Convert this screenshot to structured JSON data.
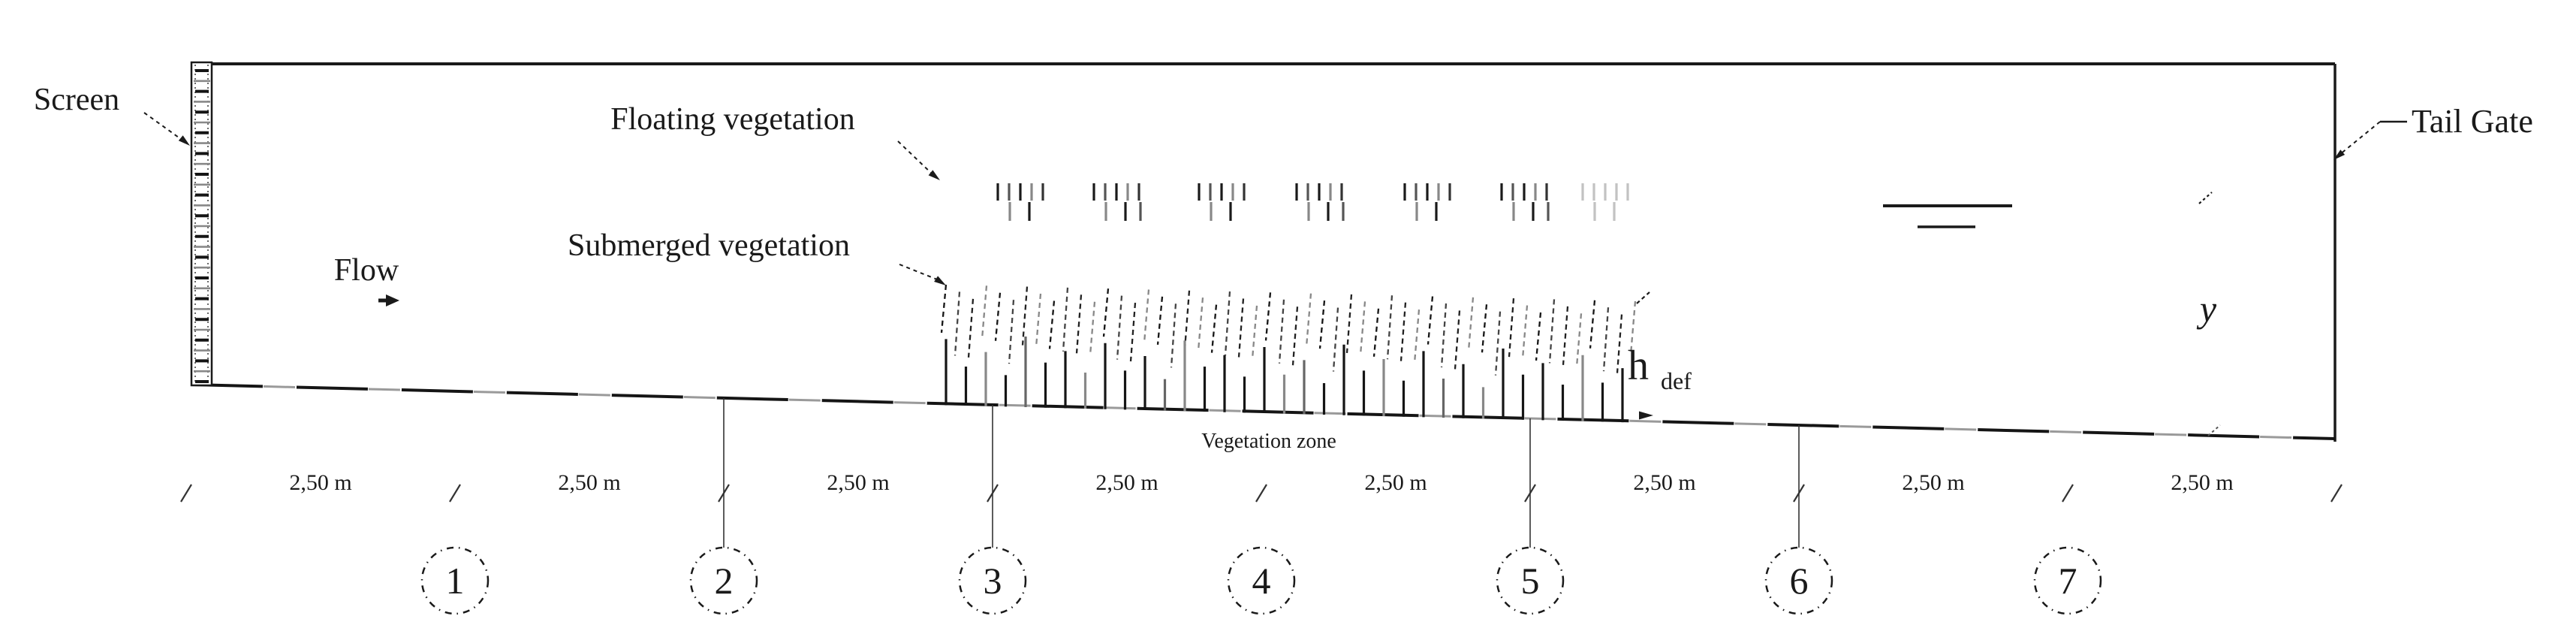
{
  "labels": {
    "screen": "Screen",
    "flow": "Flow",
    "floating_vegetation": "Floating vegetation",
    "submerged_vegetation": "Submerged vegetation",
    "vegetation_zone": "Vegetation zone",
    "h_def_base": "h",
    "h_def_sub": "def",
    "water_depth": "y",
    "tail_gate": "Tail Gate"
  },
  "dimensions": {
    "segment_labels": [
      "2,50 m",
      "2,50 m",
      "2,50 m",
      "2,50 m",
      "2,50 m",
      "2,50 m",
      "2,50 m",
      "2,50 m"
    ]
  },
  "sections": [
    "1",
    "2",
    "3",
    "4",
    "5",
    "6",
    "7"
  ],
  "colors": {
    "ink": "#1a1a1a",
    "mid": "#555555",
    "gray": "#888888",
    "faint": "#c2c2c2",
    "background": "#ffffff"
  }
}
